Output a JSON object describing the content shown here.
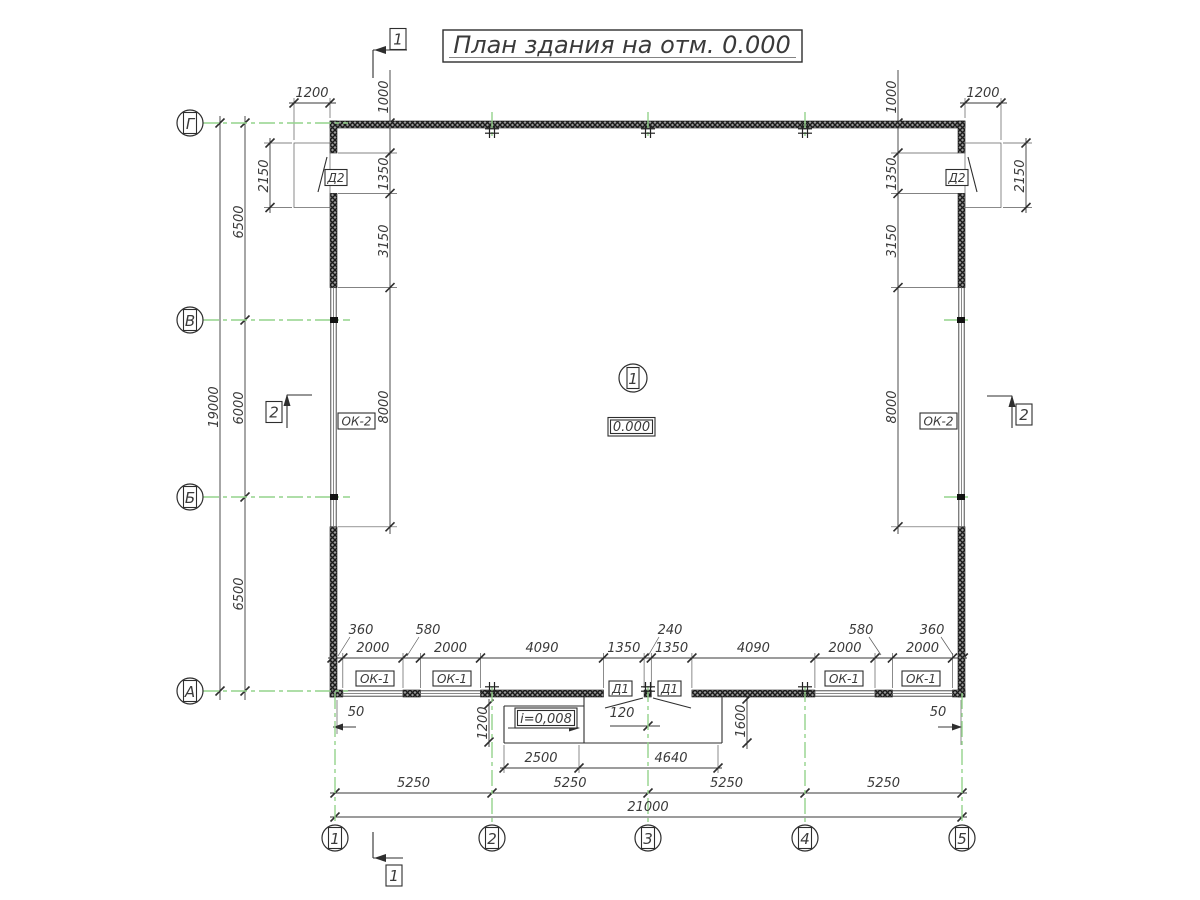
{
  "title": "План здания на отм. 0.000",
  "room": {
    "number": "1",
    "elevation": "0.000"
  },
  "marks": {
    "ok1": "ОК-1",
    "ok2": "ОК-2",
    "d1": "Д1",
    "d2": "Д2",
    "slope": "i=0,008"
  },
  "axes": {
    "cols": [
      "1",
      "2",
      "3",
      "4",
      "5"
    ],
    "rows": [
      "Г",
      "В",
      "Б",
      "А"
    ]
  },
  "sections": {
    "one": "1",
    "two": "2"
  },
  "dims": {
    "total_width": "21000",
    "total_height": "19000",
    "axis_spans_x": [
      "5250",
      "5250",
      "5250",
      "5250"
    ],
    "axis_spans_y": [
      "6500",
      "6000",
      "6500"
    ],
    "landing_width": "1200",
    "landing_height": "2150",
    "side_chain": [
      "1000",
      "1350",
      "3150",
      "8000"
    ],
    "bottom_chain": [
      "2000",
      "2000",
      "4090",
      "1350",
      "1350",
      "4090",
      "2000",
      "2000"
    ],
    "bottom_leaders": [
      "360",
      "580",
      "240",
      "580",
      "360"
    ],
    "porch_ramp_width": "2500",
    "porch_width": "4640",
    "porch_depth_left": "1200",
    "porch_depth_right": "1600",
    "door_offset": "120",
    "axis_offset": "50"
  }
}
